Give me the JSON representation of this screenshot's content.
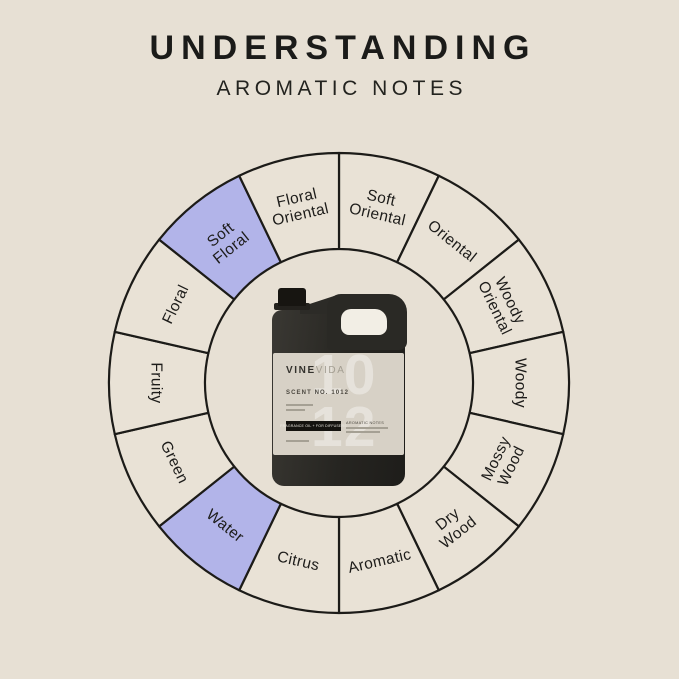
{
  "header": {
    "title": "UNDERSTANDING",
    "subtitle": "AROMATIC NOTES"
  },
  "colors": {
    "background": "#e7e0d4",
    "segment_fill": "#e9e2d6",
    "segment_highlight": "#b2b4e9",
    "stroke": "#1c1b18",
    "label_text": "#1d1c1a"
  },
  "wheel": {
    "segments": [
      {
        "label": "Soft Oriental",
        "lines": [
          "Soft",
          "Oriental"
        ],
        "highlighted": false
      },
      {
        "label": "Oriental",
        "lines": [
          "Oriental"
        ],
        "highlighted": false
      },
      {
        "label": "Woody Oriental",
        "lines": [
          "Woody",
          "Oriental"
        ],
        "highlighted": false
      },
      {
        "label": "Woody",
        "lines": [
          "Woody"
        ],
        "highlighted": false
      },
      {
        "label": "Mossy Wood",
        "lines": [
          "Mossy",
          "Wood"
        ],
        "highlighted": false
      },
      {
        "label": "Dry Wood",
        "lines": [
          "Dry",
          "Wood"
        ],
        "highlighted": false
      },
      {
        "label": "Aromatic",
        "lines": [
          "Aromatic"
        ],
        "highlighted": false
      },
      {
        "label": "Citrus",
        "lines": [
          "Citrus"
        ],
        "highlighted": false
      },
      {
        "label": "Water",
        "lines": [
          "Water"
        ],
        "highlighted": true
      },
      {
        "label": "Green",
        "lines": [
          "Green"
        ],
        "highlighted": false
      },
      {
        "label": "Fruity",
        "lines": [
          "Fruity"
        ],
        "highlighted": false
      },
      {
        "label": "Floral",
        "lines": [
          "Floral"
        ],
        "highlighted": false
      },
      {
        "label": "Soft Floral",
        "lines": [
          "Soft",
          "Floral"
        ],
        "highlighted": true
      },
      {
        "label": "Floral Oriental",
        "lines": [
          "Floral",
          "Oriental"
        ],
        "highlighted": false
      }
    ]
  },
  "product": {
    "brand_bold": "VINE",
    "brand_light": "VIDA",
    "scent_no": "SCENT NO. 1012",
    "big_number_top": "10",
    "big_number_bottom": "12",
    "bar_text": "FRAGRANCE OIL + FOR DIFFUSERS",
    "notes_heading": "AROMATIC NOTES"
  }
}
